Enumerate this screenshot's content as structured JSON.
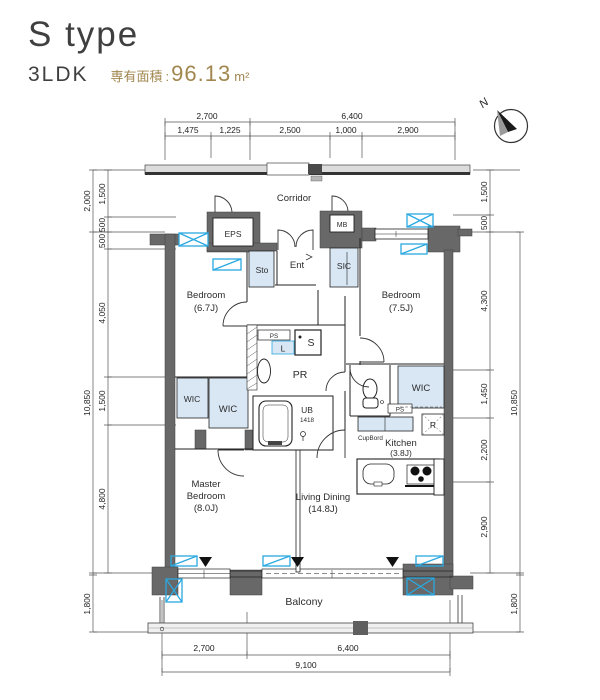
{
  "header": {
    "title": "S type",
    "layout": "3LDK",
    "area_label": "専有面積",
    "colon": ":",
    "area_value": "96.13",
    "area_unit": "m²"
  },
  "compass": {
    "north": "N"
  },
  "plan": {
    "corridor": "Corridor",
    "eps": "EPS",
    "mb": "MB",
    "ent": "Ent",
    "sic": "SIC",
    "sto": "Sto",
    "bedroom1_l1": "Bedroom",
    "bedroom1_l2": "(6.7J)",
    "bedroom2_l1": "Bedroom",
    "bedroom2_l2": "(7.5J)",
    "wic_left": "WIC",
    "wic_mid": "WIC",
    "wic_right": "WIC",
    "ps_center": "PS",
    "laundry": "L",
    "washer": "S",
    "pr": "PR",
    "ub_l1": "UB",
    "ub_l2": "1418",
    "ps_right": "PS",
    "fridge": "R",
    "cupboard": "CupBord",
    "kitchen_l1": "Kitchen",
    "kitchen_l2": "(3.8J)",
    "living_l1": "Living Dining",
    "living_l2": "(14.8J)",
    "master_l1": "Master",
    "master_l2": "Bedroom",
    "master_l3": "(8.0J)",
    "balcony": "Balcony"
  },
  "dims": {
    "top1": [
      "2,700",
      "6,400"
    ],
    "top2": [
      "1,475",
      "1,225",
      "2,500",
      "1,000",
      "2,900"
    ],
    "bottom1": [
      "2,700",
      "6,400"
    ],
    "bottom_total": "9,100",
    "left_outer": [
      "2,000",
      "10,850",
      "1,800"
    ],
    "left_inner": [
      "1,500",
      "500",
      "500",
      "4,050",
      "1,500",
      "4,800"
    ],
    "right_inner": [
      "1,500",
      "500",
      "4,300",
      "1,450",
      "2,200",
      "2,900"
    ],
    "right_outer": [
      "10,850",
      "1,800"
    ]
  },
  "colors": {
    "accent_blue": "#2aa9e0",
    "wall_gray": "#686868",
    "closet_fill": "#d9e7f5",
    "gold": "#a1874f"
  }
}
